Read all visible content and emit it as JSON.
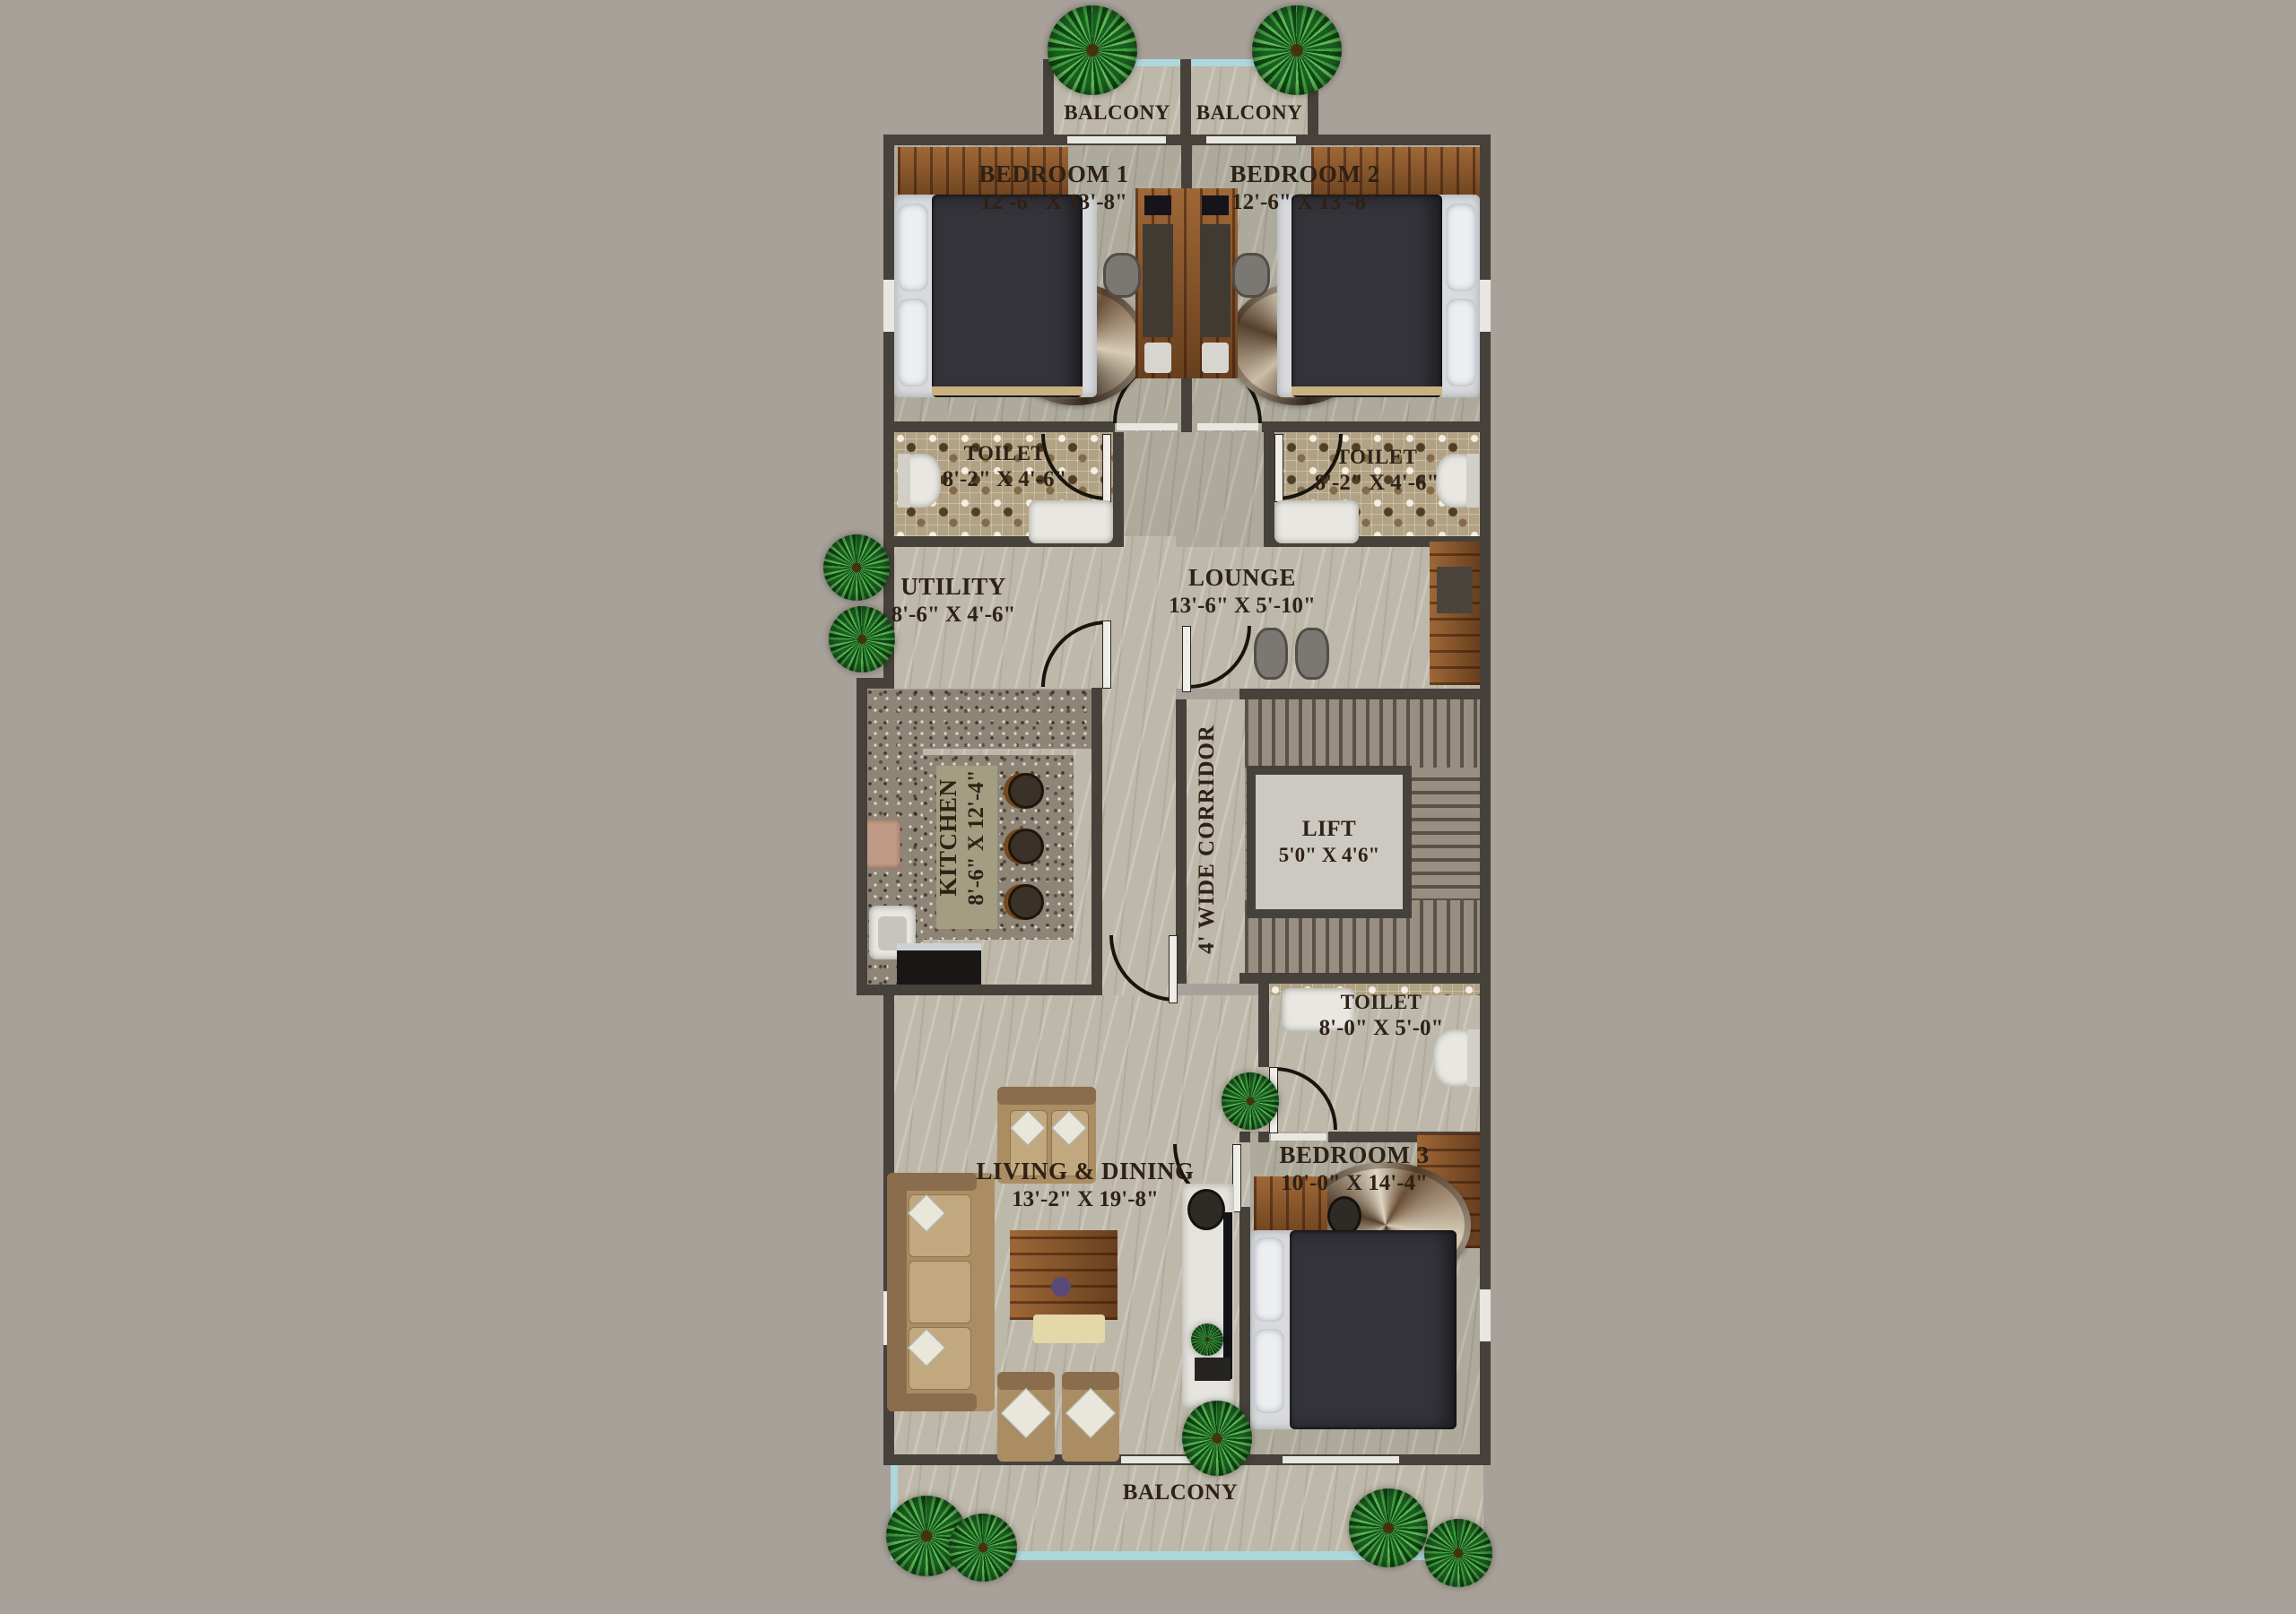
{
  "colors": {
    "background": "#a8a19a",
    "wall": "#46413b",
    "marble_floor": "#bdb8a9",
    "bedroom_floor": "#aeaa9b",
    "toilet_tile": "#b1a284",
    "stair_granite": "#988f81",
    "wood": "#8a5428",
    "glass_railing": "#aed7dc",
    "label_text": "#2e2115"
  },
  "rooms": {
    "balcony_top_left": {
      "name": "BALCONY"
    },
    "balcony_top_right": {
      "name": "BALCONY"
    },
    "bedroom1": {
      "name": "BEDROOM 1",
      "dims": "12'-6\" X 13'-8\""
    },
    "bedroom2": {
      "name": "BEDROOM 2",
      "dims": "12'-6\" X 13'-8\""
    },
    "toilet1": {
      "name": "TOILET",
      "dims": "8'-2\" X 4'-6\""
    },
    "toilet2": {
      "name": "TOILET",
      "dims": "8'-2\" X 4'-6\""
    },
    "utility": {
      "name": "UTILITY",
      "dims": "8'-6\" X 4'-6\""
    },
    "lounge": {
      "name": "LOUNGE",
      "dims": "13'-6\" X 5'-10\""
    },
    "kitchen": {
      "name": "KITCHEN",
      "dims": "8'-6\" X 12'-4\""
    },
    "corridor": {
      "name": "4' WIDE CORRIDOR"
    },
    "lift": {
      "name": "LIFT",
      "dims": "5'0\" X 4'6\""
    },
    "toilet3": {
      "name": "TOILET",
      "dims": "8'-0\" X 5'-0\""
    },
    "living_dining": {
      "name": "LIVING & DINING",
      "dims": "13'-2\" X 19'-8\""
    },
    "bedroom3": {
      "name": "BEDROOM 3",
      "dims": "10'-0\" X 14'-4\""
    },
    "balcony_bottom": {
      "name": "BALCONY"
    }
  }
}
